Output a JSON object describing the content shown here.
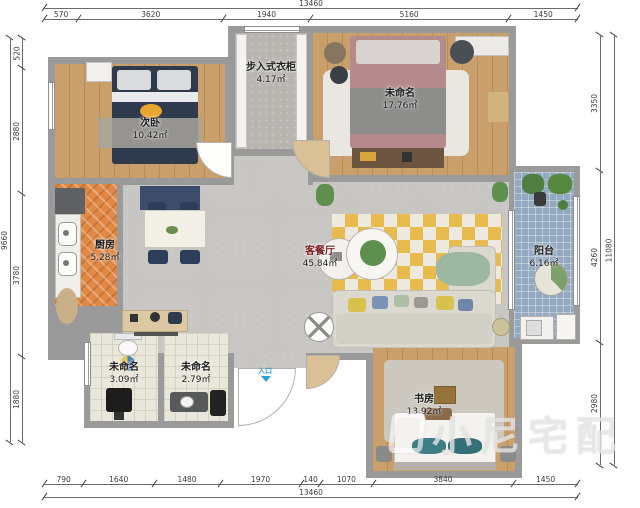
{
  "plan": {
    "entry_label": "入口",
    "watermark": "小尼宅配"
  },
  "rooms": {
    "ciwo": {
      "name": "次卧",
      "area": "10.42㎡"
    },
    "closet": {
      "name": "步入式衣柜",
      "area": "4.17㎡"
    },
    "master": {
      "name": "未命名",
      "area": "17.76㎡"
    },
    "kitchen": {
      "name": "厨房",
      "area": "5.28㎡"
    },
    "living": {
      "name": "客餐厅",
      "area": "45.84㎡"
    },
    "balcony": {
      "name": "阳台",
      "area": "6.16㎡"
    },
    "bath_a": {
      "name": "未命名",
      "area": "3.09㎡"
    },
    "bath_b": {
      "name": "未命名",
      "area": "2.79㎡"
    },
    "study": {
      "name": "书房",
      "area": "13.92㎡"
    }
  },
  "dimensions": {
    "top": {
      "total": "13460",
      "segments": [
        "570",
        "3620",
        "1940",
        "5160",
        "1450"
      ]
    },
    "bottom": {
      "total": "13460",
      "segments": [
        "790",
        "1640",
        "1480",
        "1970",
        "140",
        "1070",
        "3840",
        "1450"
      ]
    },
    "left": {
      "total": "9660",
      "segments": [
        "520",
        "2880",
        "3780",
        "1880"
      ]
    },
    "right": {
      "total": "11080",
      "segments": [
        "3350",
        "4260",
        "2980"
      ]
    }
  },
  "colors": {
    "wall": "#9a9a9a",
    "wood_floor": "#c9a06b",
    "kitchen_floor": "#e08945",
    "living_floor": "#c8c6c3",
    "balcony_floor": "#93a9bf",
    "bath_floor": "#e9e7db",
    "entry_accent": "#2b9fd6",
    "bed_navy": "#2f3a4d",
    "rug_yellow": "#e7bb4e"
  }
}
